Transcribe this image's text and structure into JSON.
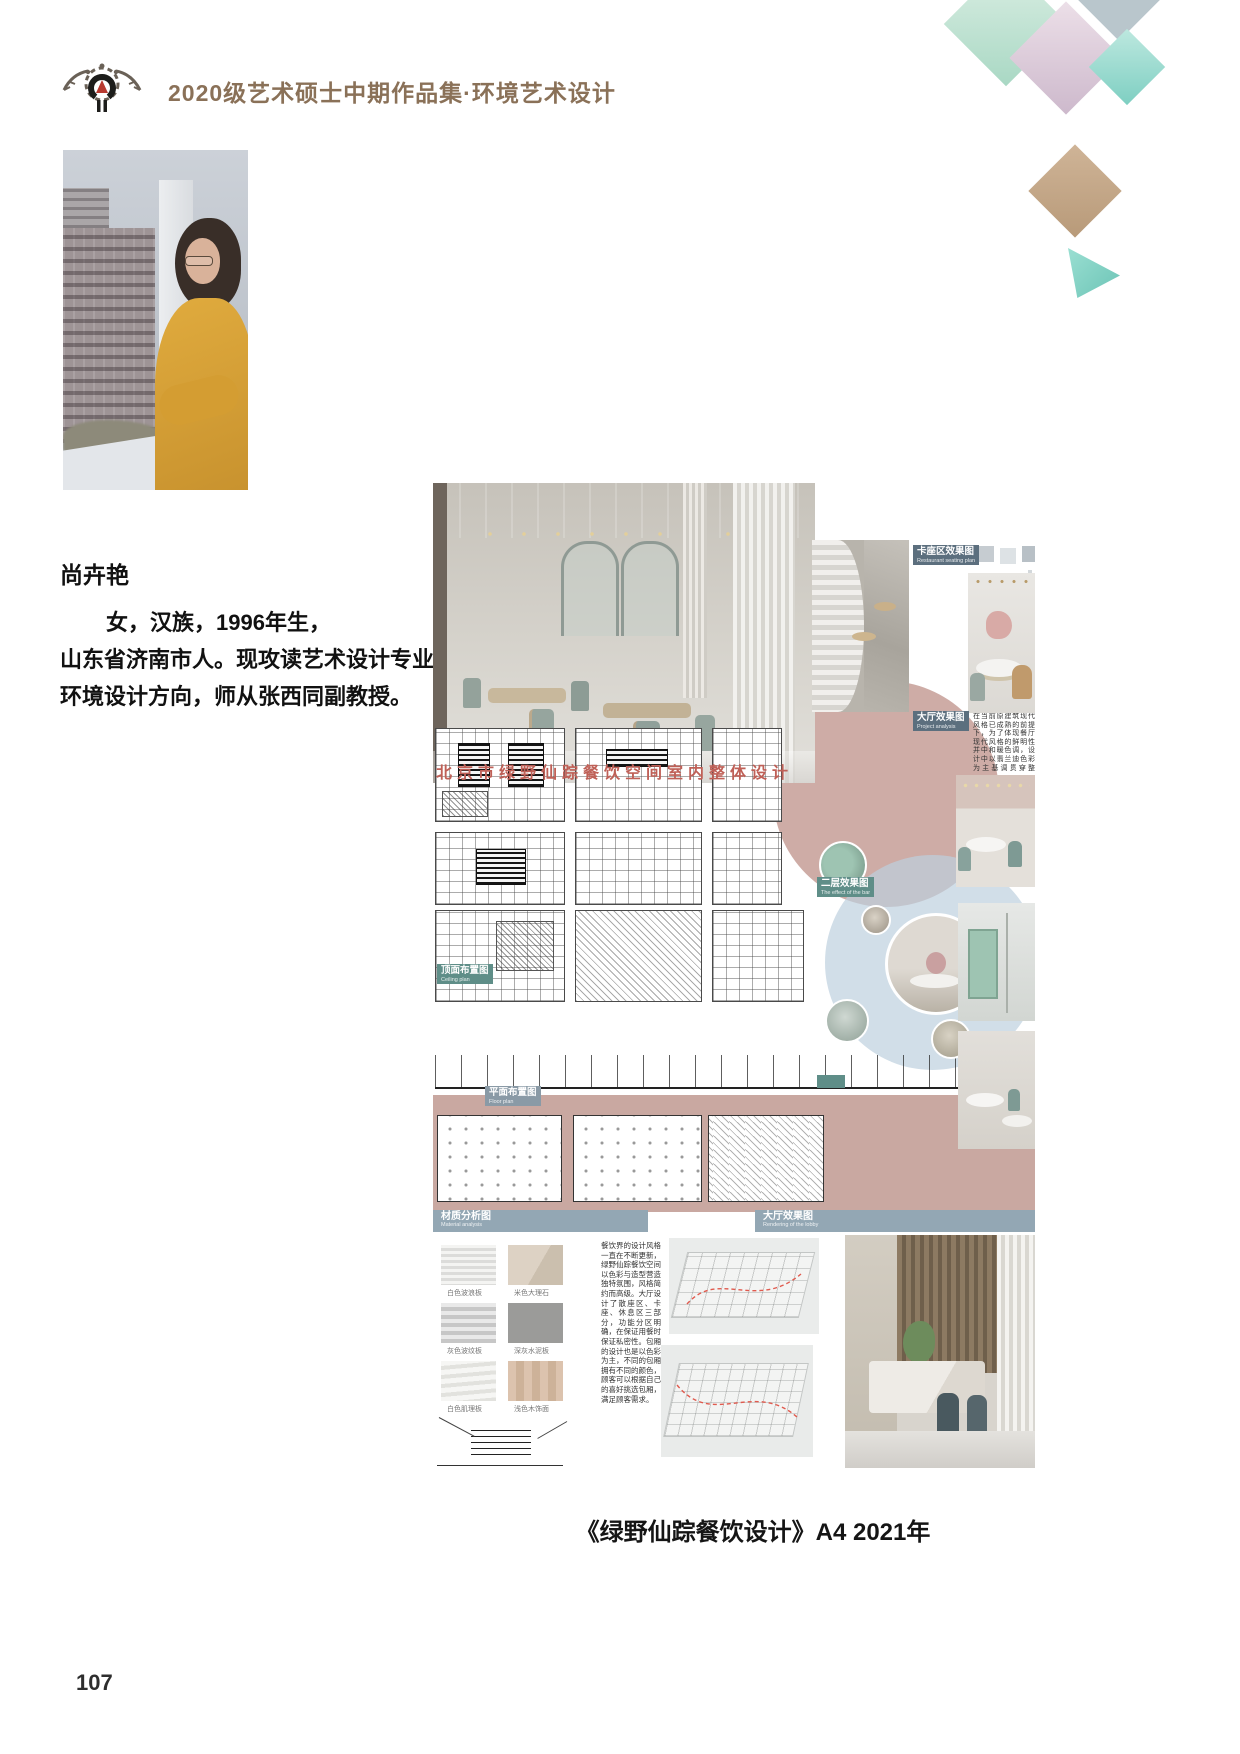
{
  "header": {
    "title": "2020级艺术硕士中期作品集·环境艺术设计"
  },
  "bio": {
    "name": "尚卉艳",
    "line1": "女，汉族，1996年生，",
    "line2": "山东省济南市人。现攻读艺术设计专业",
    "line3": "环境设计方向，师从张西同副教授。"
  },
  "artwork": {
    "overlay_title": "北京市绿野仙踪餐饮空间室内整体设计",
    "labels": {
      "seat": {
        "zh": "卡座区效果图",
        "en": "Restaurant seating plan"
      },
      "hall": {
        "zh": "大厅效果图",
        "en": "Project analysis"
      },
      "floor2": {
        "zh": "二层效果图",
        "en": "The effect of the bar"
      },
      "ceiling": {
        "zh": "顶面布置图",
        "en": "Ceiling plan"
      },
      "floorplan": {
        "zh": "平面布置图",
        "en": "Floor plan"
      },
      "material": {
        "zh": "材质分析图",
        "en": "Material analysis"
      },
      "lobby": {
        "zh": "大厅效果图",
        "en": "Rendering of the lobby"
      }
    },
    "analysis_text": "在当前原建筑现代风格已成熟的前提下，为了体现餐厅现代风格的鲜明性并中和暖色调，设计中以翡兰迪色彩为主基调贯穿整体，使顾客在用餐时感到新鲜愉悦。",
    "design_text": "餐饮界的设计风格一直在不断更新，绿野仙踪餐饮空间以色彩与造型营造独特氛围，风格简约而高级。大厅设计了散座区、卡座、休息区三部分，功能分区明确，在保证用餐时保证私密性。包厢的设计也是以色彩为主，不同的包厢拥有不同的颜色，顾客可以根据自己的喜好挑选包厢，满足顾客需求。",
    "swatch_captions": [
      "白色波浪板",
      "米色大理石",
      "灰色波纹板",
      "深灰水泥板",
      "白色肌理板",
      "浅色木饰面"
    ]
  },
  "caption": "《绿野仙踪餐饮设计》A4 2021年",
  "page_number": "107",
  "colors": {
    "accent_brown": "#8a7158",
    "dusty_pink": "#c9a49d",
    "title_red": "#bf6057",
    "label_slate": "#5c6f7e",
    "label_teal": "#5f8e88",
    "banner_blue": "#93a7b4",
    "mint": "#cfe7da",
    "mustard": "#d9a33b"
  }
}
